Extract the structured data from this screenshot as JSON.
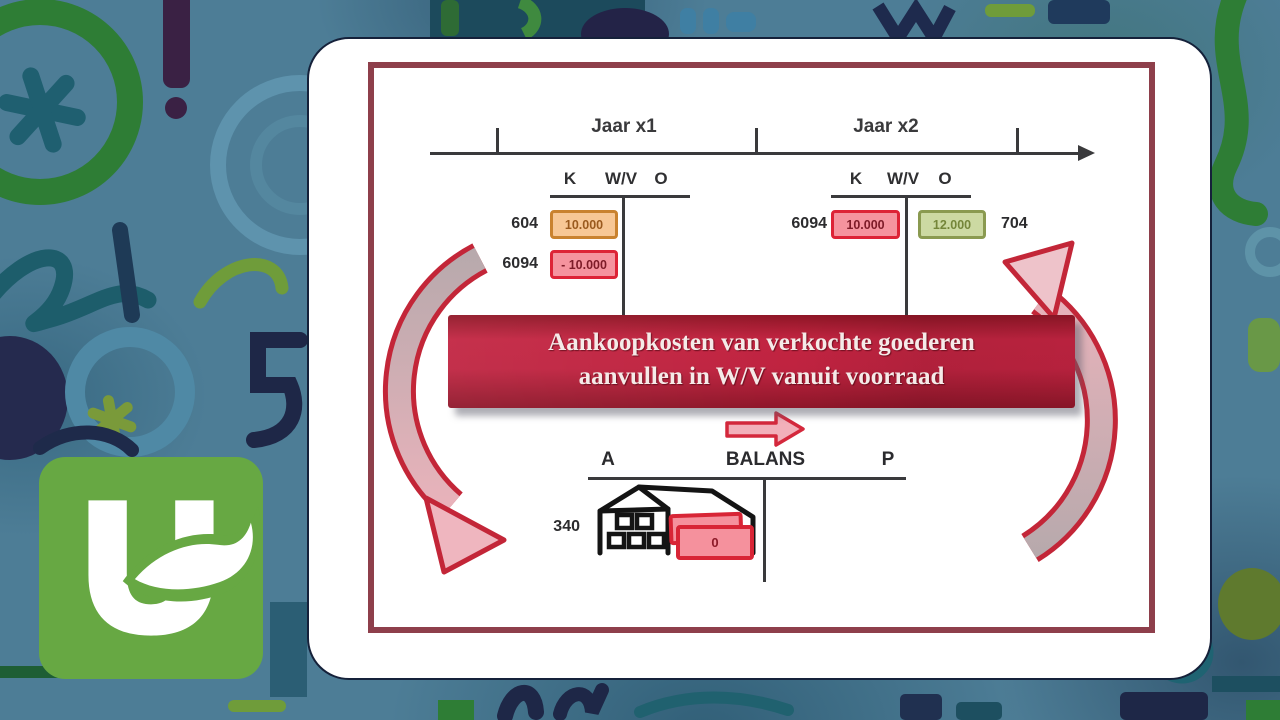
{
  "slide": {
    "timeline": {
      "year1": "Jaar x1",
      "year2": "Jaar x2"
    },
    "t1": {
      "k": "K",
      "wv": "W/V",
      "o": "O",
      "row1_code": "604",
      "row1_value": "10.000",
      "row2_code": "6094",
      "row2_value": "- 10.000"
    },
    "t2": {
      "k": "K",
      "wv": "W/V",
      "o": "O",
      "debit_code": "6094",
      "debit_value": "10.000",
      "credit_value": "12.000",
      "credit_code": "704"
    },
    "banner": {
      "line1": "Aankoopkosten van verkochte goederen",
      "line2": "aanvullen in W/V vanuit voorraad"
    },
    "balans": {
      "assets_label": "A",
      "title": "BALANS",
      "liabilities_label": "P",
      "stock_code": "340",
      "stock_value": "0"
    }
  },
  "icons": {
    "logo": "uhasselt-u-leaf",
    "flow_left": "curved-arrow-down",
    "flow_right": "curved-arrow-up",
    "transfer": "arrow-right",
    "warehouse": "warehouse-building-with-crates"
  },
  "colors": {
    "background_teal": "#4d7d96",
    "accent_red": "#c32638",
    "banner_red": "#bf2340",
    "inner_border_maroon": "#8e3f4b",
    "box_orange_fill": "#f7c795",
    "box_orange_border": "#c9822f",
    "box_pink_fill": "#f5939e",
    "box_pink_border": "#dd2336",
    "box_green_fill": "#ccd9a2",
    "box_green_border": "#8a9a50",
    "logo_green": "#67a843"
  }
}
